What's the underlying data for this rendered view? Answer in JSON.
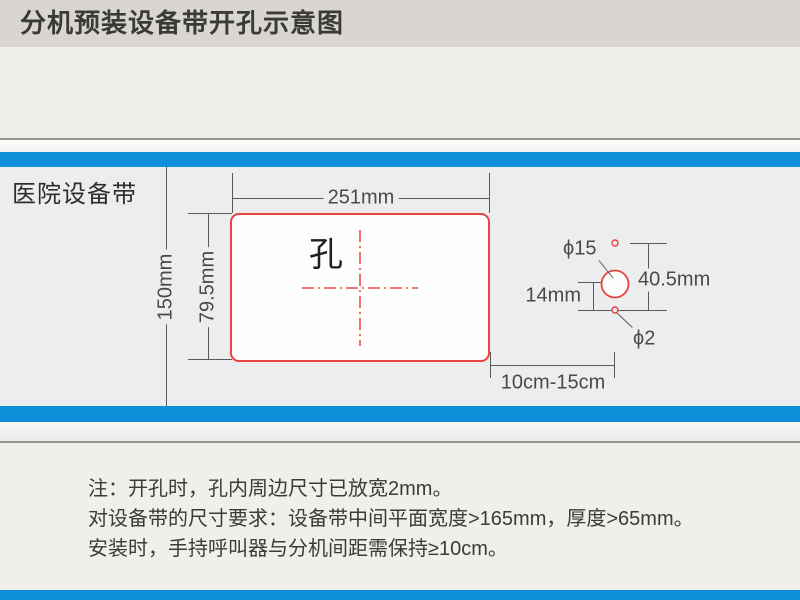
{
  "title_bar": {
    "title": "分机预装设备带开孔示意图"
  },
  "band": {
    "label": "医院设备带",
    "hole_label": "孔"
  },
  "dimensions": {
    "rect_width": "251mm",
    "rect_height": "79.5mm",
    "band_height": "150mm",
    "hole_gap": "40.5mm",
    "hole_offset": "14mm",
    "big_hole": "ϕ15",
    "small_hole": "ϕ2",
    "install_distance": "10cm-15cm"
  },
  "notes": [
    "注：开孔时，孔内周边尺寸已放宽2mm。",
    "对设备带的尺寸要求：设备带中间平面宽度>165mm，厚度>65mm。",
    "安装时，手持呼叫器与分机间距需保持≥10cm。"
  ],
  "colors": {
    "accent_blue": "#0c8ed8",
    "outline_red": "#e8433e",
    "centerline_red": "#ef4c47",
    "band_face": "#ecedef"
  }
}
